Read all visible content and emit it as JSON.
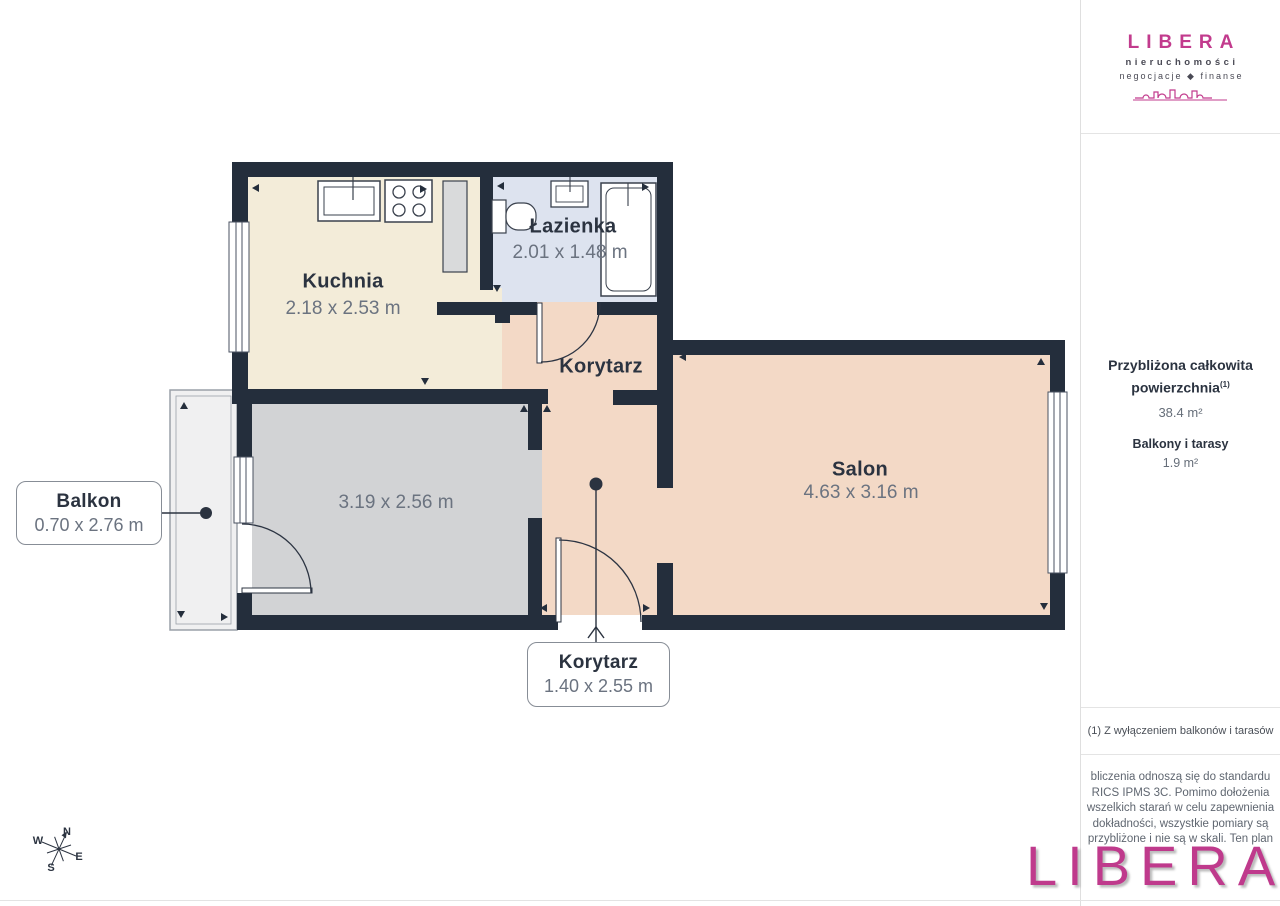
{
  "plan": {
    "rooms": {
      "kuchnia": {
        "name": "Kuchnia",
        "dims": "2.18 x 2.53 m"
      },
      "lazienka": {
        "name": "Łazienka",
        "dims": "2.01 x 1.48 m"
      },
      "korytarz": {
        "name": "Korytarz"
      },
      "salon": {
        "name": "Salon",
        "dims": "4.63 x 3.16 m"
      },
      "pokoj": {
        "dims": "3.19 x 2.56 m"
      }
    },
    "callouts": {
      "balkon": {
        "name": "Balkon",
        "dims": "0.70 x 2.76 m"
      },
      "korytarz_dolny": {
        "name": "Korytarz",
        "dims": "1.40 x 2.55 m"
      }
    },
    "compass": {
      "n": "N",
      "e": "E",
      "s": "S",
      "w": "W"
    }
  },
  "sidebar": {
    "logo": {
      "brand": "LIBERA",
      "tagline1": "nieruchomości",
      "tagline2": "negocjacje ◆ finanse"
    },
    "summary": {
      "title_line1": "Przybliżona całkowita",
      "title_line2": "powierzchnia",
      "title_footnote_ref": "(1)",
      "total_area": "38.4 m²",
      "balconies_label": "Balkony i tarasy",
      "balconies_area": "1.9 m²"
    },
    "footnote": "(1) Z wyłączeniem balkonów i tarasów",
    "disclaimer_lines": [
      "bliczenia odnoszą się do standardu",
      "RICS IPMS 3C. Pomimo dołożenia",
      "wszelkich starań w celu zapewnienia",
      "dokładności, wszystkie pomiary są",
      "przybliżone i nie są w skali. Ten plan"
    ],
    "watermark": "LIBERA"
  },
  "colors": {
    "wall": "#242e3c",
    "floor_kitchen": "#f3ecd9",
    "floor_bathroom": "#dde3ef",
    "floor_living": "#f3d9c6",
    "floor_room": "#d2d3d5",
    "balcony": "#f0f0f1",
    "brand": "#c23b8d"
  }
}
